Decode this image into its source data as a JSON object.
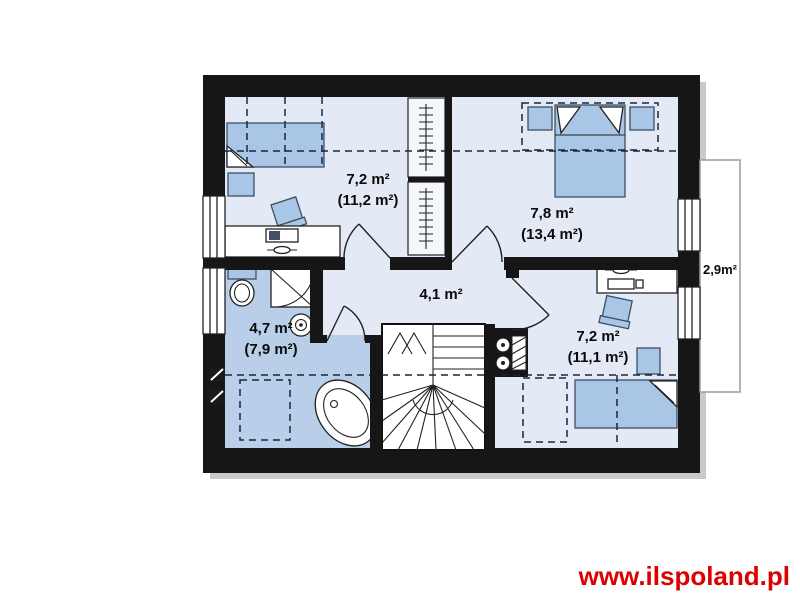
{
  "colors": {
    "wall": "#161616",
    "floor": "#e3eaf5",
    "bathroom-floor": "#b9cee8",
    "furniture": "#a9c6e6",
    "furniture-outline": "#3c4f66",
    "dashed-line": "#17273f",
    "shadow": "#c9c9c9",
    "balcony-outline": "#9a9a9a",
    "label": "#0a0a0a",
    "watermark": "#dd0000"
  },
  "floor_plan": {
    "type": "attic-storey house plan",
    "rooms": [
      {
        "name": "bedroom-top-left",
        "floor_area": "7,2 m²",
        "total_area": "(11,2 m²)"
      },
      {
        "name": "bedroom-top-right",
        "floor_area": "7,8 m²",
        "total_area": "(13,4 m²)"
      },
      {
        "name": "hall",
        "floor_area": "4,1 m²"
      },
      {
        "name": "bathroom",
        "floor_area": "4,7 m²",
        "total_area": "(7,9 m²)"
      },
      {
        "name": "bedroom-bottom-right",
        "floor_area": "7,2 m²",
        "total_area": "(11,1 m²)"
      },
      {
        "name": "balcony",
        "floor_area": "2,9m²"
      }
    ]
  },
  "watermark": {
    "text": "www.ilspoland.pl"
  }
}
